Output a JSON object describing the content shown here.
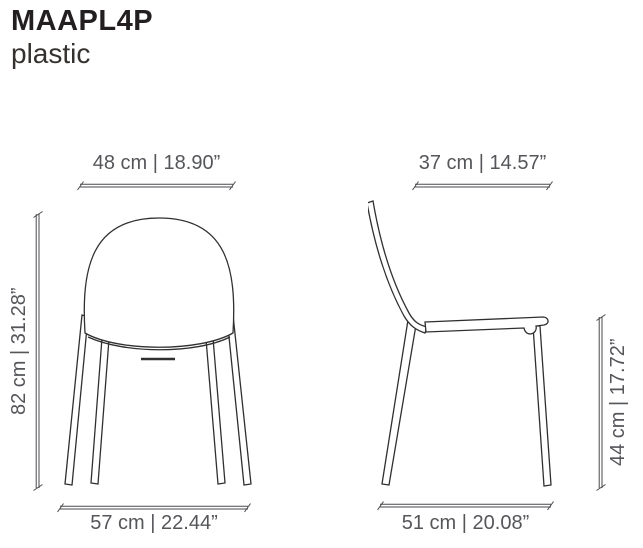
{
  "header": {
    "model": "MAAPL4P",
    "material": "plastic"
  },
  "colors": {
    "background": "#ffffff",
    "title_text": "#231f20",
    "dimension_text": "#55565a",
    "dimension_line": "#4a4a4d",
    "drawing_line": "#303032"
  },
  "front_view": {
    "name": "front view",
    "width_top": "48 cm | 18.90”",
    "height_left": "82 cm | 31.28”",
    "width_bottom": "57 cm | 22.44”"
  },
  "side_view": {
    "name": "side view",
    "depth_top": "37 cm | 14.57”",
    "seat_height_right": "44 cm | 17.72”",
    "depth_bottom": "51 cm | 20.08”"
  }
}
